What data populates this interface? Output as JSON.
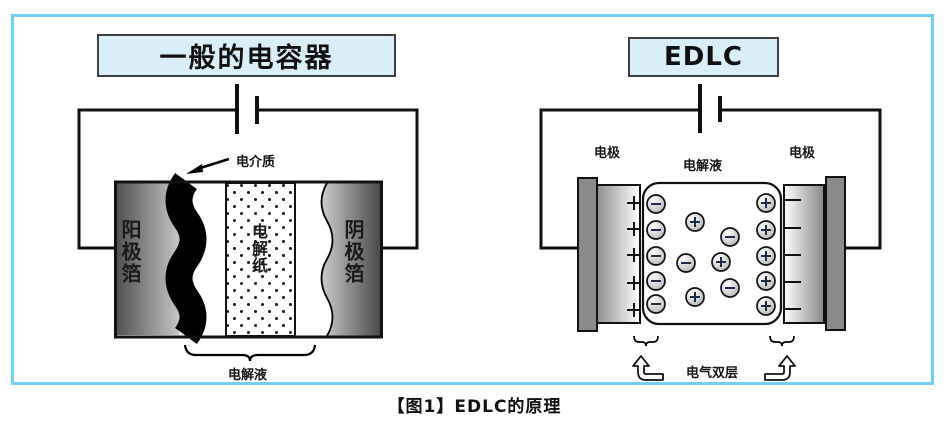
{
  "figure": {
    "caption": "【图1】EDLC的原理"
  },
  "left_diagram": {
    "title": "一般的电容器",
    "labels": {
      "dielectric": "电介质",
      "anode_foil": "阳极箔",
      "electrolytic_paper": "电解纸",
      "cathode_foil": "阴极箔",
      "electrolyte": "电解液"
    }
  },
  "right_diagram": {
    "title": "EDLC",
    "labels": {
      "electrode_left": "电极",
      "electrolyte": "电解液",
      "electrode_right": "电极",
      "electric_double_layer": "电气双层"
    },
    "ions": {
      "anion_symbol": "−",
      "cation_symbol": "+",
      "left_layer_anion_count": 5,
      "right_layer_cation_count": 5,
      "free_ion_count": 6,
      "electrode_plus_marks": 5,
      "electrode_minus_marks": 5
    }
  },
  "colors": {
    "panel_border": "#74cdf2",
    "title_box_bg": "#daeef8",
    "title_box_border": "#3f3f3f",
    "line": "#111111",
    "collector_bar": "#8a8a8a",
    "ion_stroke": "#1b2b4a"
  }
}
